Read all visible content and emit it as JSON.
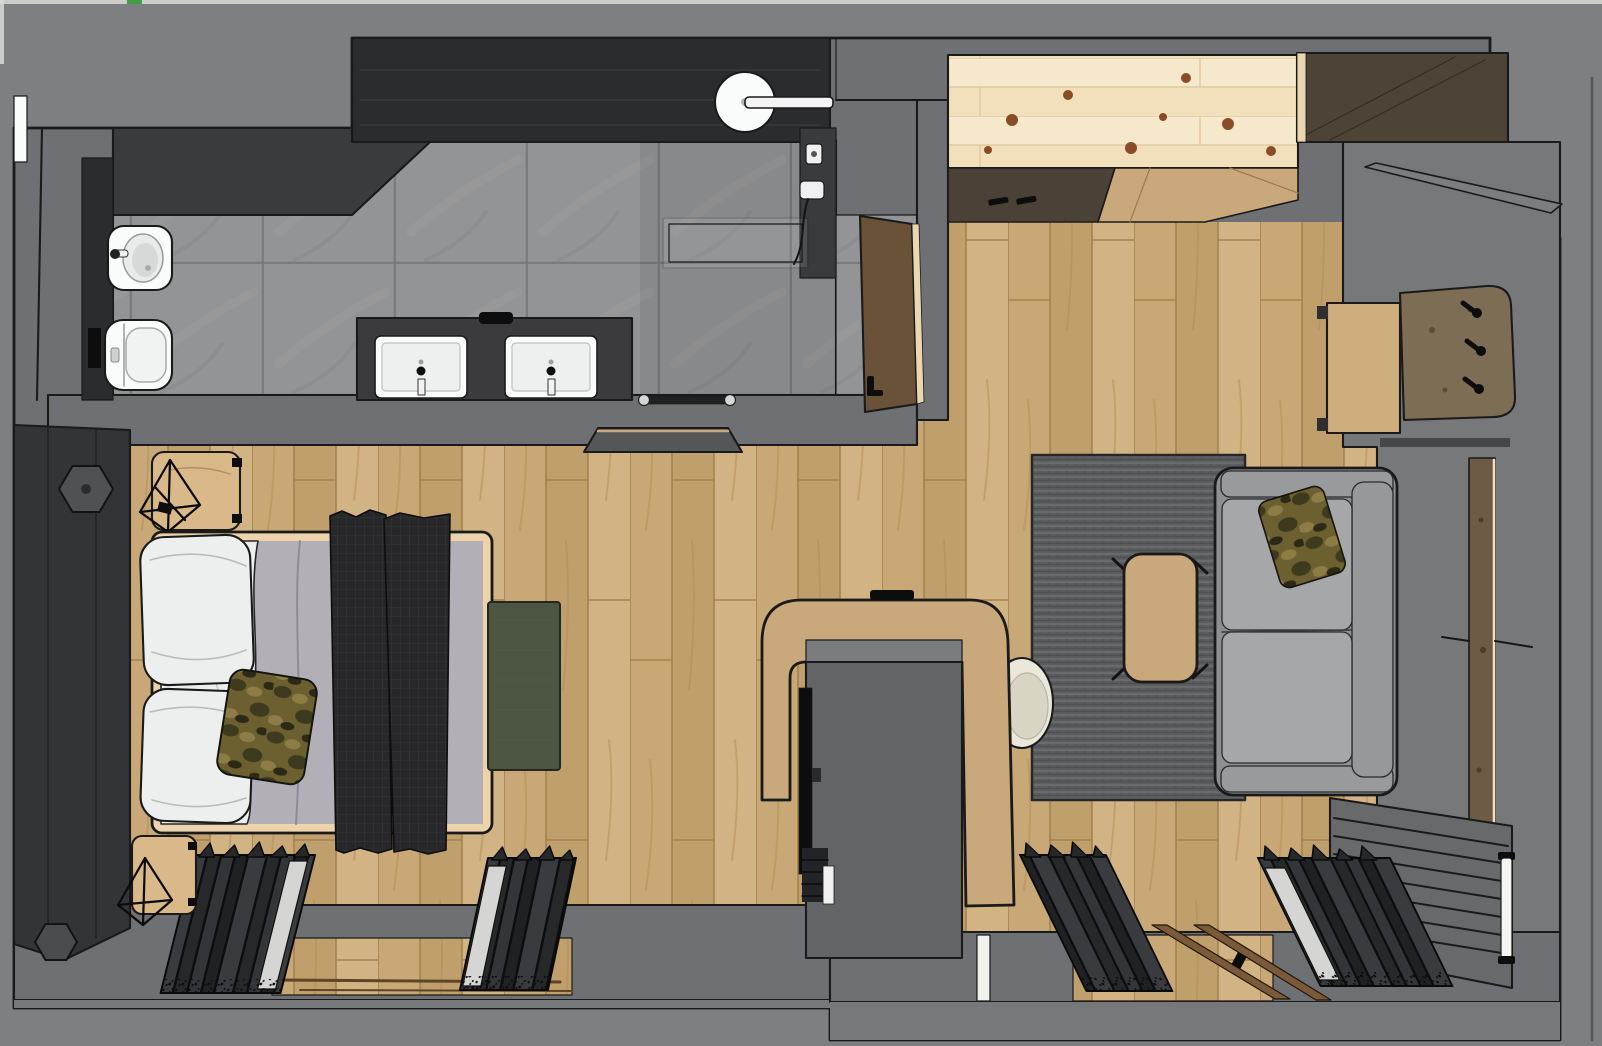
{
  "meta": {
    "title": "hotel-suite-3d-floor-plan-top-view",
    "canvas_width": 1602,
    "canvas_height": 1046,
    "style": "sketchup-render, no visible text"
  },
  "palette": {
    "bg": "#7e7f81",
    "wall": "#6f7073",
    "wall2": "#77787a",
    "outline": "#1a1a1b",
    "charcoal": "#2b2c2e",
    "darkwall": "#3a3b3d",
    "tile": "#939495",
    "grout": "#7a7b7c",
    "tileStreak": "#a2a3a4",
    "plank1": "#c8a876",
    "plank2": "#bfa06c",
    "plank3": "#d2b384",
    "plankSeam": "#a5824f",
    "plankGrain": "#b08a55",
    "pine1": "#f6e8cb",
    "pine2": "#f0ddb6",
    "pineSeam": "#dcc69d",
    "knot": "#8a4b28",
    "knotRing": "#6e3a1e",
    "oak": "#c9a87c",
    "oakLight": "#cfae7e",
    "bedFrame": "#ecd3ab",
    "woodStool": "#d9b88a",
    "walnut": "#4e4337",
    "doorWood": "#6a5238",
    "doorEdge": "#ead6b0",
    "plankWall": "#6e5b45",
    "plankEdge": "#f2e3c2",
    "trackWood": "#7a5a38",
    "counter": "#3b3b3d",
    "white": "#fafbfb",
    "porcelain": "#d7d9d9",
    "sofa": "#8e8f91",
    "sofaArm": "#999a9c",
    "sofaCushion": "#a6a7a9",
    "sofaBack": "#97989a",
    "rugBase": "#5c5e60",
    "rugLight": "#696b6e",
    "rugDark": "#4e5052",
    "duvet": "#b2afb7",
    "sheet": "#edefef",
    "throw": "#28282b",
    "throwLine": "#313134",
    "camoBase": "#6d6030",
    "camoDark": "#3e3a1d",
    "camoLight": "#8d7c45",
    "camoDeep": "#2c2917",
    "greenMat": "#4c5442",
    "chairCream": "#eae7db",
    "chairInner": "#d9d5c5",
    "cloth1": "#26282a",
    "cloth2": "#393b3e",
    "cloth3": "#1f2123",
    "cloth4": "#333538",
    "clothLight": "#d5d5d3",
    "clothGap": "#0c0d0e",
    "slatPanel": "#68696b",
    "postWhite": "#f4f4f1",
    "kitchenFront": "#4a4236",
    "hexSconce": "#505154",
    "headboard": "#333437",
    "black": "#0d0d0e",
    "blockGray": "#636466",
    "blockTop": "#7b7c7e",
    "shelfGray": "#55565a",
    "panelSeat": "#7e6d55",
    "artifactGreen": "#3f9e47",
    "edgeLight": "#d9dad8"
  },
  "scene": {
    "view": "top-down 3d floor plan of a studio hotel suite",
    "rooms": [
      {
        "name": "bathroom",
        "floor": "grey stone tiles",
        "fixtures": [
          "bidet",
          "toilet",
          "double-sink-vanity",
          "walk-in-shower",
          "rain-shower-head",
          "glass-partition",
          "towel-rail",
          "dark-feature-walls"
        ]
      },
      {
        "name": "entrance-corridor",
        "fixtures": [
          "entrance-door",
          "wall-shelf"
        ]
      },
      {
        "name": "kitchenette",
        "fixtures": [
          "pine-overhead-unit",
          "dark-cabinet-fronts",
          "counter-wedge",
          "walnut-wardrobe-top",
          "parapet-wall"
        ]
      },
      {
        "name": "bedroom",
        "floor": "oak planks",
        "fixtures": [
          "double-bed",
          "white-pillows",
          "camo-accent-pillow",
          "dark-throw-runners",
          "headboard-panel",
          "hex-sconces",
          "nightstand-top",
          "nightstand-bottom",
          "wire-lamps",
          "green-foot-mat",
          "open-wardrobe-clothes"
        ]
      },
      {
        "name": "living-area",
        "floor": "oak planks",
        "fixtures": [
          "grey-sofa",
          "camo-sofa-pillow",
          "area-rug",
          "coffee-table",
          "tv-partition-desk",
          "tv",
          "cream-desk-chair",
          "desk",
          "coat-peg-panel",
          "wall-plank-panel",
          "slatted-radiator",
          "towel-post",
          "sliding-door-tracks",
          "open-wardrobe-clothes"
        ]
      }
    ]
  }
}
